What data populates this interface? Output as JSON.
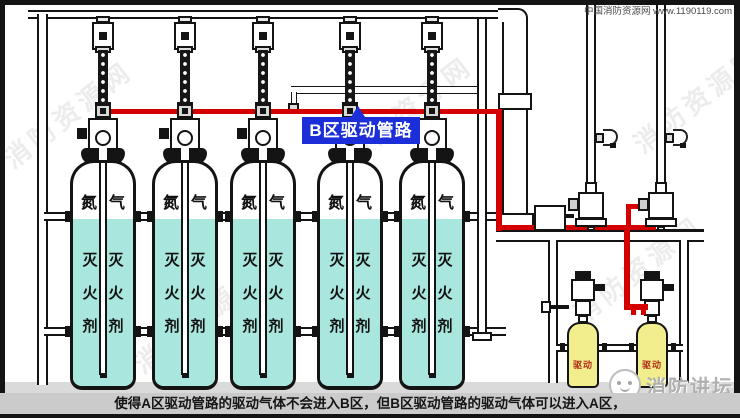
{
  "watermark_site": "中国消防资源网 www.1190119.com",
  "bg_watermark": "消防资源网",
  "cyl": {
    "gas": "氮气",
    "agent": "灭火剂"
  },
  "drive": {
    "label": "驱动"
  },
  "pipe_label_b": "B区驱动管路",
  "logo_text": "消防讲坛",
  "caption": "使得A区驱动管路的驱动气体不会进入B区，但B区驱动管路的驱动气体可以进入A区，",
  "colors": {
    "pipe_red": "#d40000",
    "label_blue": "#1b2ed8",
    "agent_cyan": "#a9e6dd",
    "drive_yellow": "#f2ee8d"
  }
}
